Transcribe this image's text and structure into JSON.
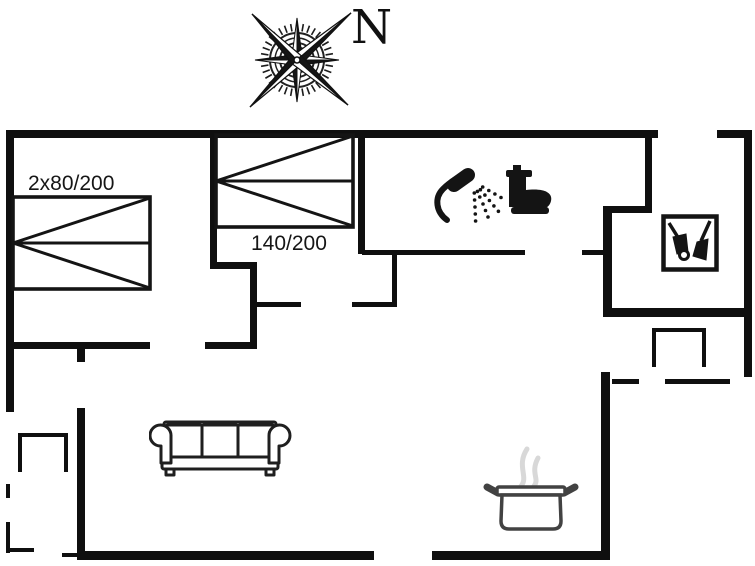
{
  "page": {
    "type": "holiday-house floor plan"
  },
  "colors": {
    "background": "#ffffff",
    "wall": "#0f0f0f",
    "icon_black": "#141414",
    "sofa_outline": "#1f1f1f",
    "pot_outline": "#424242",
    "steam": "#d8d8d8"
  },
  "compass": {
    "north_label": "N",
    "icon": "compass-rose-icon"
  },
  "beds": {
    "double": {
      "label": "2x80/200"
    },
    "standard": {
      "label": "140/200"
    }
  },
  "icons": {
    "shower": "shower-icon",
    "toilet": "toilet-icon",
    "utility": "cleaning-tools-icon",
    "sofa": "sofa-icon",
    "pot": "cooking-pot-icon",
    "compass": "compass-rose-icon"
  },
  "floorplan": {
    "walls_thick": [
      [
        6,
        130,
        652,
        8
      ],
      [
        717,
        130,
        35,
        8
      ],
      [
        744,
        130,
        8,
        247
      ],
      [
        6,
        130,
        8,
        282
      ],
      [
        603,
        308,
        149,
        9
      ],
      [
        601,
        372,
        9,
        188
      ],
      [
        77,
        551,
        297,
        9
      ],
      [
        432,
        551,
        178,
        9
      ],
      [
        77,
        345,
        8,
        17
      ],
      [
        77,
        408,
        8,
        151
      ],
      [
        6,
        342,
        144,
        7
      ],
      [
        205,
        342,
        52,
        7
      ],
      [
        250,
        264,
        7,
        85
      ],
      [
        210,
        134,
        7,
        133
      ],
      [
        210,
        262,
        47,
        7
      ],
      [
        358,
        134,
        7,
        120
      ],
      [
        645,
        134,
        7,
        78
      ],
      [
        603,
        206,
        49,
        7
      ],
      [
        603,
        206,
        9,
        111
      ]
    ],
    "walls_thin": [
      [
        362,
        250,
        163,
        5
      ],
      [
        582,
        250,
        21,
        5
      ],
      [
        257,
        302,
        44,
        5
      ],
      [
        352,
        302,
        45,
        5
      ],
      [
        392,
        253,
        5,
        52
      ],
      [
        612,
        379,
        27,
        5
      ],
      [
        665,
        379,
        65,
        5
      ],
      [
        652,
        328,
        54,
        4
      ],
      [
        652,
        328,
        4,
        39
      ],
      [
        702,
        328,
        4,
        39
      ],
      [
        18,
        433,
        50,
        4
      ],
      [
        18,
        433,
        4,
        39
      ],
      [
        64,
        433,
        4,
        39
      ],
      [
        6,
        484,
        4,
        14
      ],
      [
        6,
        522,
        4,
        31
      ],
      [
        6,
        548,
        28,
        4
      ],
      [
        62,
        553,
        16,
        4
      ]
    ]
  }
}
